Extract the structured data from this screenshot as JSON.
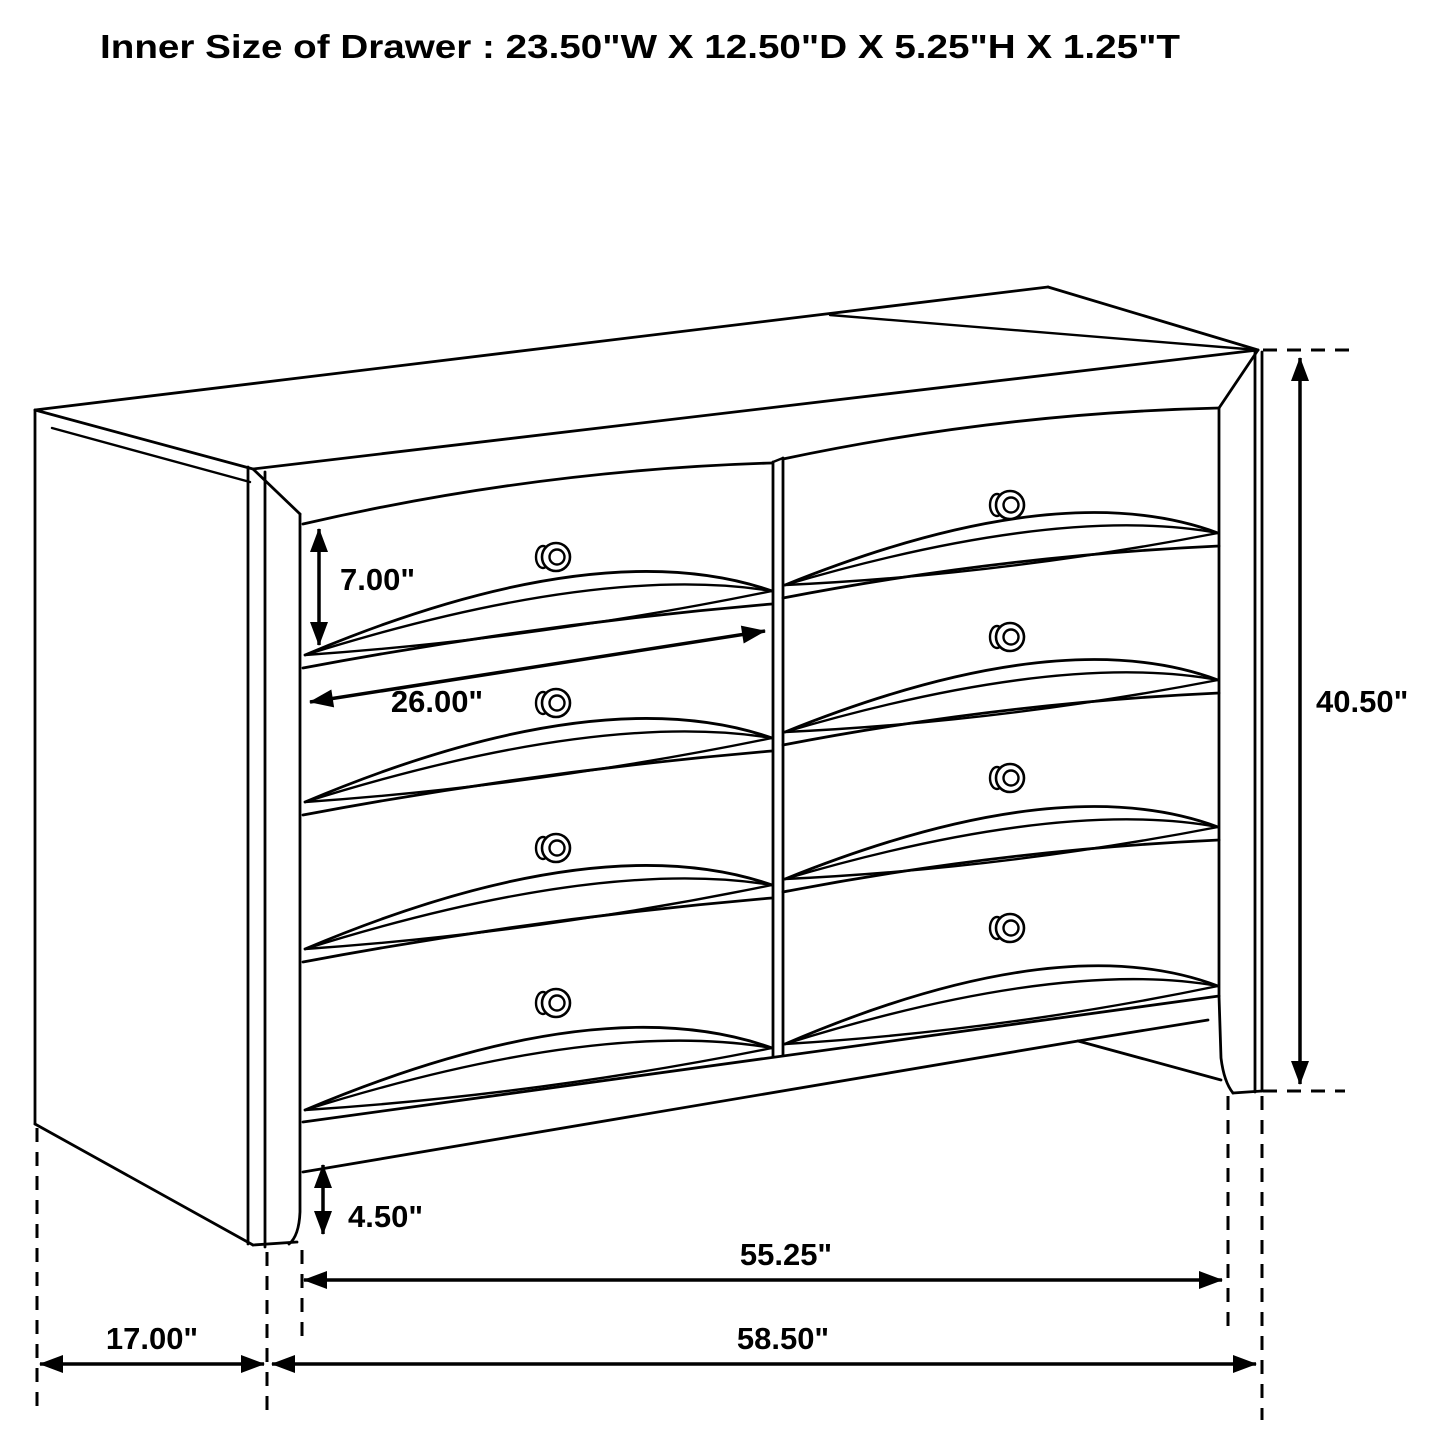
{
  "header": {
    "title": "Inner Size of Drawer : 23.50\"W X 12.50\"D X 5.25\"H X 1.25\"T"
  },
  "figure": {
    "type": "furniture-dimension-diagram",
    "subject": "eight-drawer dresser, perspective line drawing",
    "drawer_rows": 4,
    "drawer_columns": 2,
    "knob_count": 8,
    "line_color": "#000000",
    "background_color": "#ffffff"
  },
  "dimensions": {
    "drawer_front_height": "7.00\"",
    "drawer_opening_width": "26.00\"",
    "overall_height": "40.50\"",
    "leg_height": "4.50\"",
    "case_width": "55.25\"",
    "overall_width": "58.50\"",
    "depth": "17.00\""
  }
}
